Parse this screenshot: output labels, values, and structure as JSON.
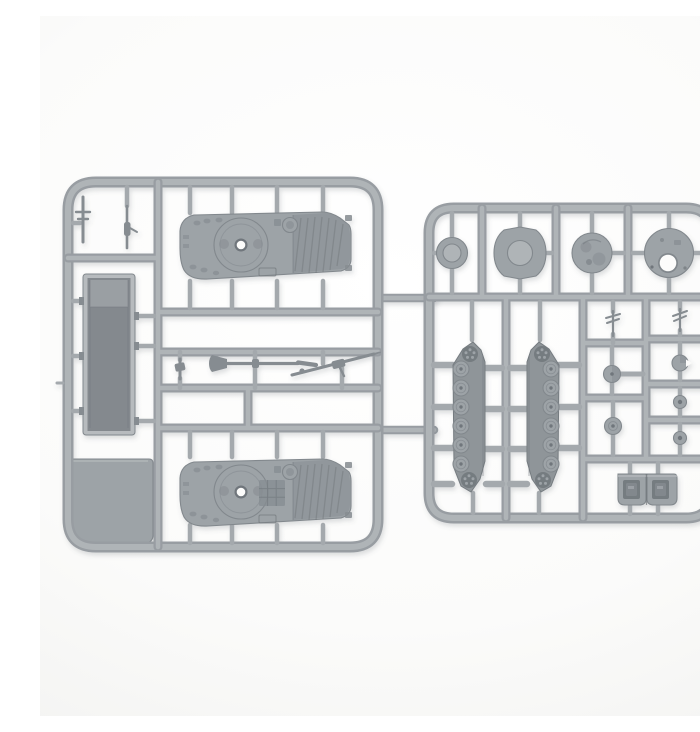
{
  "scene": {
    "type": "product-photo",
    "description": "Top-down photograph of two light grey plastic model-kit sprues on a white background, holding miniature armoured-vehicle parts: two hull tops with turret rings, an open hull tub, a flat floor panel, gun barrels, four round turret discs and hatches, two tracked running-gear runs with road wheels and sprockets, assorted small wheels and aerials, and a pair of rear doors."
  },
  "palette": {
    "bg_top": "#ffffff",
    "bg_mid": "#fbfbfa",
    "bg_edge": "#f0f0ee",
    "sprue_edge": "#989da2",
    "sprue_core": "#afb4b7",
    "nub": "#a4a9ad",
    "part": "#9da3a7",
    "part_edge": "#82888d",
    "part_dark": "#868c91",
    "recess": "#70767b",
    "lip": "#b7bbbe",
    "tub_inner": "#84898e",
    "track_body": "#8f9599",
    "sprocket": "#757b80",
    "hole": "#fcfcfb",
    "shadow": "#5c636a"
  },
  "labels": {
    "figure": "Two grey plastic model sprues with armoured vehicle parts",
    "left_sprue": "Hull sprue: two hull tops, hull tub, floor panel, gun barrels and aerials",
    "right_sprue": "Detail sprue: turret discs, track runs, wheels, hatches and rear doors",
    "hull_top_a": "Vehicle hull top piece (upper)",
    "hull_top_b": "Vehicle hull top piece (lower)",
    "hull_tub": "Open hull tub piece",
    "floor_panel": "Flat floor panel piece",
    "aerial_cross": "Cross-shaped aerial piece",
    "aerial_rod": "Thin rod aerial piece",
    "mg_part": "Small machine-gun piece",
    "gun_barrel": "Main gun barrel piece",
    "missile_rail": "Missile launcher rail piece",
    "disc_small": "Small turret ring disc",
    "disc_large": "Large round hatch disc",
    "disc_detailed": "Detailed turret top disc",
    "disc_hole": "Turret top disc with hatch hole",
    "track_left": "Track run with road wheels (left)",
    "track_right": "Track run with road wheels (right)",
    "wheel_with_bar": "Idler wheel with axle bar",
    "wheel_plain": "Idler wheel",
    "disc_notched": "Notched hatch disc",
    "small_wheel_1": "Small road wheel",
    "small_wheel_2": "Small road wheel",
    "aerial_grid_left": "Aerial piece",
    "aerial_grid_right": "Aerial piece",
    "rear_doors": "Rear door pair piece"
  }
}
